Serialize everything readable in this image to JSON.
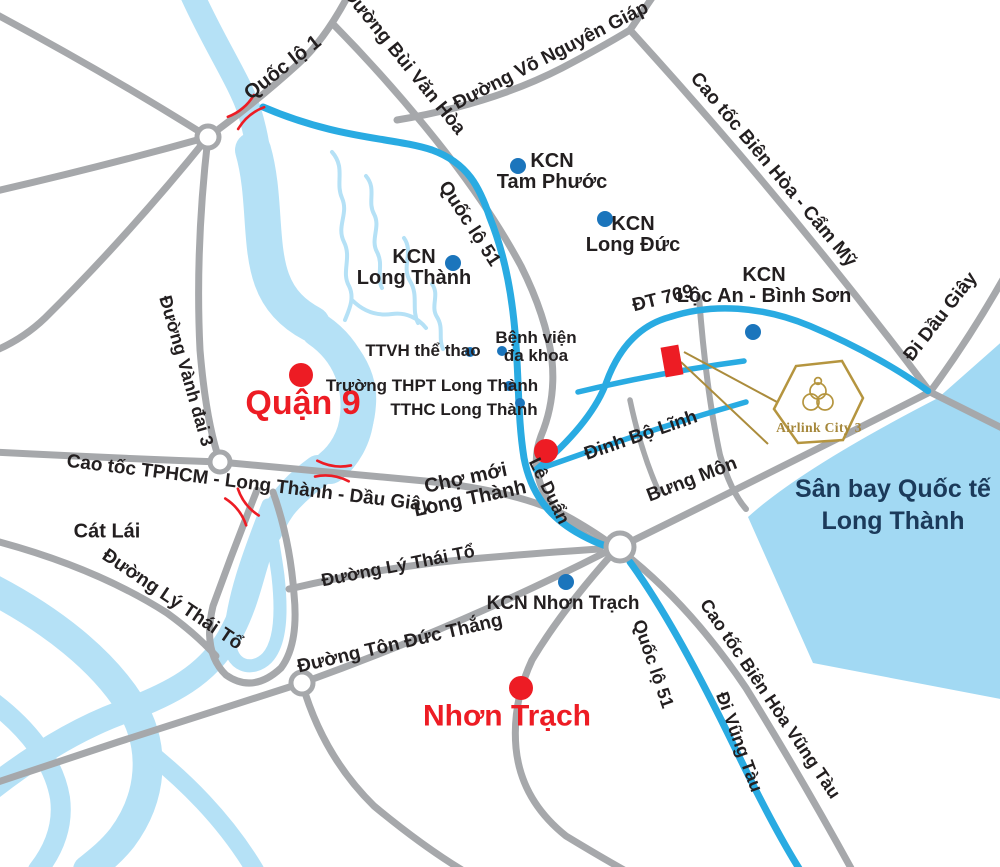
{
  "highways": {
    "quoc_lo_1": "Quốc lộ 1",
    "quoc_lo_51": "Quốc lộ 51",
    "dt_769": "ĐT 769",
    "cao_toc_tphcm_long_thanh_dau_giay": "Cao tốc TPHCM - Long Thành - Dầu Giây",
    "cao_toc_bien_hoa_cam_my": "Cao tốc Biên Hòa - Cẩm Mỹ",
    "cao_toc_bien_hoa_vung_tau": "Cao tốc Biên Hòa Vũng Tàu",
    "di_dau_giay": "Đi Dầu Giây",
    "di_vung_tau": "Đi Vũng Tàu"
  },
  "streets": {
    "bui_van_hoa": "Đường Bùi Văn Hòa",
    "vo_nguyen_giap": "Đường Võ Nguyên Giáp",
    "vanh_dai_3": "Đường Vành đai 3",
    "ly_thai_to": "Đường Lý Thái Tổ",
    "ton_duc_thang": "Đường Tôn Đức Thắng",
    "le_duan": "Lê Duẩn",
    "dinh_bo_linh": "Đinh Bộ Lĩnh",
    "bung_mon": "Bưng Môn"
  },
  "places": {
    "quan_9": "Quận 9",
    "nhon_trach": "Nhơn Trạch",
    "cat_lai": "Cát Lái"
  },
  "industrial_zones": {
    "tam_phuoc": {
      "kcn": "KCN",
      "name": "Tam Phước"
    },
    "long_duc": {
      "kcn": "KCN",
      "name": "Long Đức"
    },
    "long_thanh": {
      "kcn": "KCN",
      "name": "Long Thành"
    },
    "loc_an_binh_son": {
      "kcn": "KCN",
      "name": "Lộc An - Bình Sơn"
    },
    "nhon_trach": {
      "name": "KCN Nhơn Trạch"
    }
  },
  "facilities": {
    "ttvh_the_thao": "TTVH thể thao",
    "benh_vien": {
      "line1": "Bệnh viện",
      "line2": "đa khoa"
    },
    "truong_thpt_long_thanh": "Trường THPT Long Thành",
    "tthc_long_thanh": "TTHC Long Thành",
    "cho_moi": {
      "line1": "Chợ mới",
      "line2": "Long Thành"
    }
  },
  "airport": {
    "line1": "Sân bay Quốc tế",
    "line2": "Long Thành"
  },
  "project": {
    "brand": "Airlink City 3"
  },
  "colors": {
    "river": "#b5e1f6",
    "airport_fill": "#a2d9f3",
    "road_gray": "#a6a8ab",
    "road_blue": "#29abe2",
    "marker_red": "#ed1c24",
    "marker_blue": "#1b75bc",
    "text_black": "#231f20",
    "text_navy": "#1b3a5a",
    "gold": "#b5953f"
  }
}
